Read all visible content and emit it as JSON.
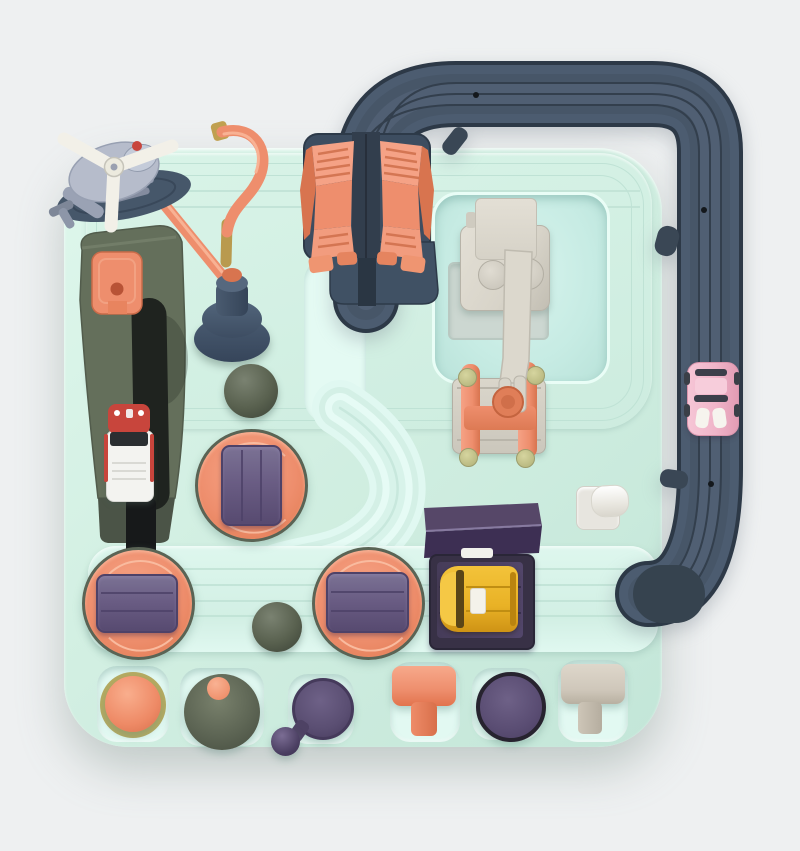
{
  "meta": {
    "type": "product-photo",
    "subject": "kids race-track adventure toy board, top view"
  },
  "colors": {
    "bg": "#eef0f1",
    "board": "#d2efe2",
    "board_hi": "#def7ec",
    "board_lo": "#c3e6d8",
    "bright": "#e4faf3",
    "groove": "#bfe2d5",
    "recess1": "#d7f4ed",
    "recess2": "#b9e2d9",
    "well": "#e2f9f2",
    "track": "#4c5c70",
    "track_edge": "#2d3947",
    "track_groove": "#333f4d",
    "track_band2": "#475668",
    "track_band3": "#505f73",
    "track_dark": "#36434f",
    "coral": "#ee8e6d",
    "coral_hi": "#f5a286",
    "coral_dark": "#d8744f",
    "navy": "#3d4d60",
    "navy_dark": "#2d3a49",
    "slot": "#1f231f",
    "olive": "#657058",
    "olive_dark": "#4b5447",
    "ball1": "#59614f",
    "plate": "#6a5d84",
    "plate_dark": "#4e4268",
    "wedge_top": "#564768",
    "wedge_front": "#3d2f53",
    "purple_knob": "#5a4e72",
    "purple_deep": "#4a3e61",
    "arm": "#d8d4c9",
    "arm_hi": "#e3dfd5",
    "arm_dark": "#b7b3a8",
    "heli": "#b6bccb",
    "rotor": "#f2f0e8",
    "pad": "#46576a",
    "white": "#f3f3f0",
    "yellow": "#e9b226",
    "yellow_hi": "#f5c845",
    "yellow_dark": "#c08e12",
    "pink": "#f0b5c9",
    "pink_hi": "#f7cddb",
    "red": "#c8453c",
    "beige": "#cfc7ba",
    "brass": "#c0a050"
  },
  "parts": {
    "board": {
      "name": "game-board-base",
      "color_key": "board"
    },
    "outer_track": {
      "name": "elevated-track-loop",
      "color_key": "track",
      "cars": [
        {
          "name": "pink-car",
          "color_key": "pink"
        }
      ]
    },
    "gate": {
      "name": "orange-mountain-gate",
      "color_key": "coral"
    },
    "helicopter": {
      "name": "helicopter-on-pad",
      "body_color_key": "heli",
      "rotor_color_key": "rotor"
    },
    "robotic_arm": {
      "name": "gray-robotic-arm",
      "color_key": "arm"
    },
    "stations": [
      {
        "name": "turntable-1",
        "color_key": "coral"
      },
      {
        "name": "turntable-2",
        "color_key": "coral"
      },
      {
        "name": "turntable-3",
        "color_key": "coral"
      },
      {
        "name": "yellow-car-dock",
        "car": "yellow-car",
        "color_key": "yellow"
      },
      {
        "name": "ambulance-slide",
        "car": "ambulance-car",
        "color_key": "white"
      },
      {
        "name": "purple-ramp-roof",
        "color_key": "wedge_top"
      },
      {
        "name": "white-roller",
        "color_key": "white"
      },
      {
        "name": "plunger-pump",
        "color_key": "navy"
      }
    ],
    "controls": [
      {
        "name": "orange-dome-button",
        "color_key": "coral"
      },
      {
        "name": "olive-cone-knob",
        "color_key": "olive"
      },
      {
        "name": "joystick-knob",
        "color_key": "purple_knob"
      },
      {
        "name": "orange-t-lever",
        "color_key": "coral"
      },
      {
        "name": "purple-round-button",
        "color_key": "purple_knob"
      },
      {
        "name": "beige-t-lever",
        "color_key": "beige"
      }
    ]
  }
}
